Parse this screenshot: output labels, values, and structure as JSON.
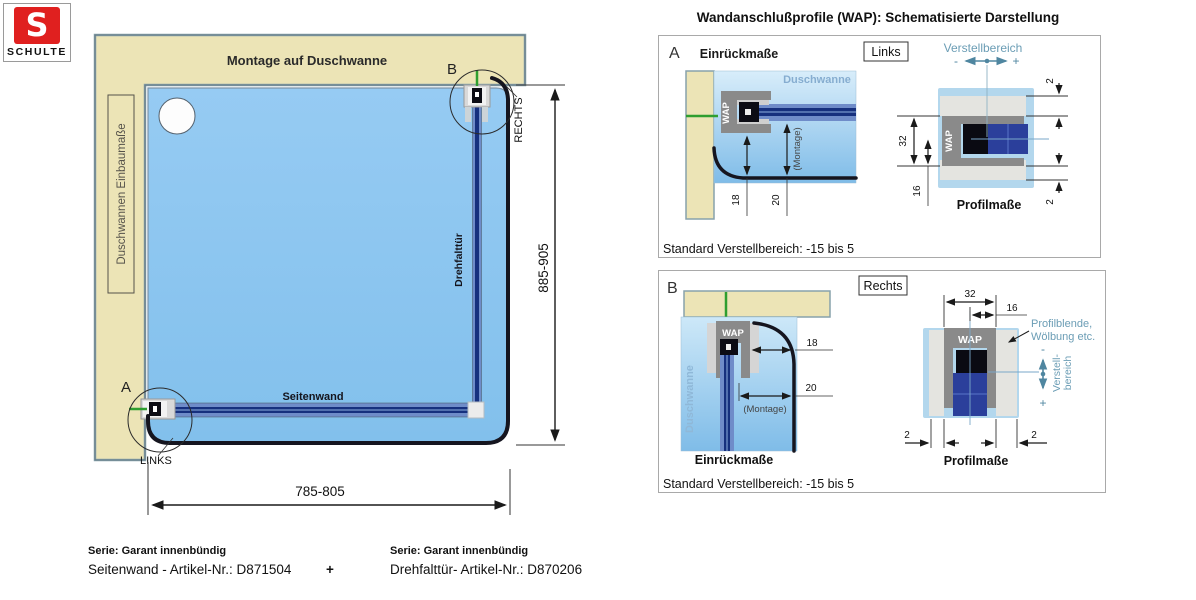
{
  "logo": {
    "letter": "S",
    "brand": "SCHULTE"
  },
  "main": {
    "wall_label": "Montage auf Duschwanne",
    "tray_label": "Duschwannen Einbaumaße",
    "point_a": "A",
    "point_b": "B",
    "links": "LINKS",
    "rechts": "RECHTS",
    "seitenwand": "Seitenwand",
    "drehfalttuer": "Drehfalttür",
    "dim_width": "785-805",
    "dim_height": "885-905"
  },
  "wap": {
    "title": "Wandanschlußprofile (WAP): Schematisierte Darstellung",
    "panel_a": {
      "letter": "A",
      "einrueckmasse": "Einrückmaße",
      "tag": "Links",
      "verstellbereich": "Verstellbereich",
      "minus": "-",
      "plus": "+",
      "duschwanne": "Duschwanne",
      "wap": "WAP",
      "montage": "(Montage)",
      "dim18": "18",
      "dim20": "20",
      "dim32": "32",
      "dim16": "16",
      "dim2_top": "2",
      "dim2_bottom": "2",
      "profilmasse": "Profilmaße",
      "note": "Standard Verstellbereich: -15 bis 5"
    },
    "panel_b": {
      "letter": "B",
      "tag": "Rechts",
      "duschwanne": "Duschwanne",
      "wap": "WAP",
      "montage": "(Montage)",
      "einrueckmasse": "Einrückmaße",
      "dim18": "18",
      "dim20": "20",
      "dim32": "32",
      "dim16": "16",
      "dim2_left": "2",
      "dim2_right": "2",
      "profilblende_1": "Profilblende,",
      "profilblende_2": "Wölbung etc.",
      "verstell_1": "Verstell-",
      "verstell_2": "bereich",
      "minus": "-",
      "plus": "+",
      "profilmasse": "Profilmaße",
      "note": "Standard Verstellbereich: -15 bis 5"
    }
  },
  "footer": {
    "serie_left": "Serie: Garant innenbündig",
    "artikel_left": "Seitenwand - Artikel-Nr.: D871504",
    "plus": "+",
    "serie_right": "Serie: Garant innenbündig",
    "artikel_right": "Drehfalttür- Artikel-Nr.: D870206"
  },
  "colors": {
    "wall_beige": "#ece4b6",
    "tray_blue": "#8cc6f0",
    "panel_blue": "#b3d7ed",
    "bar_dark_blue": "#16307e",
    "bar_light_blue": "#6f8cc9",
    "profile_grey": "#8a8a8a",
    "teal_label": "#6b9db5",
    "green_mark": "#2f9e2f",
    "rim_black": "#15151f",
    "logo_red": "#e0201f"
  }
}
